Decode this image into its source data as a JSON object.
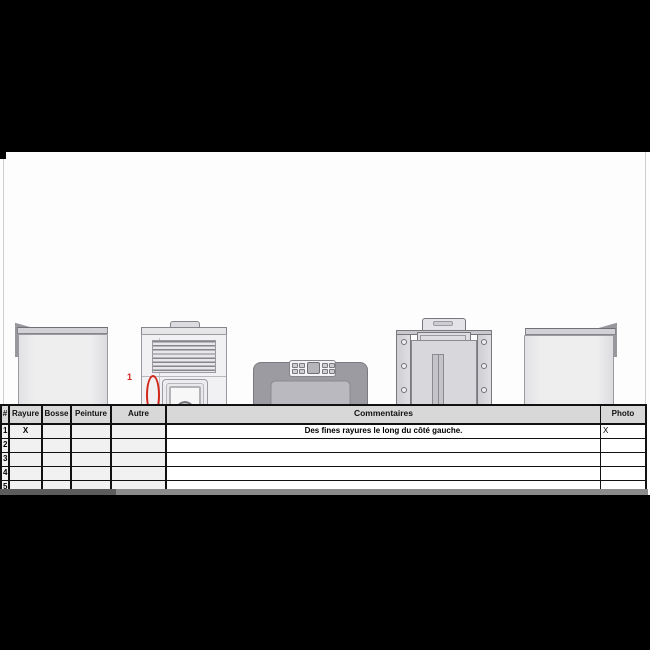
{
  "annotation": {
    "label": "1"
  },
  "colors": {
    "annotation_red": "#d2261a",
    "table_header_bg": "#d8d8d8",
    "letterbox": "#000000"
  },
  "table": {
    "headers": {
      "num": "#",
      "rayure": "Rayure",
      "bosse": "Bosse",
      "peinture": "Peinture",
      "autre": "Autre",
      "commentaires": "Commentaires",
      "photo": "Photo"
    },
    "rows": [
      {
        "num": "1",
        "rayure": "X",
        "bosse": "",
        "peinture": "",
        "autre": "",
        "commentaires": "Des fines rayures le long du côté gauche.",
        "photo": "X"
      },
      {
        "num": "2",
        "rayure": "",
        "bosse": "",
        "peinture": "",
        "autre": "",
        "commentaires": "",
        "photo": ""
      },
      {
        "num": "3",
        "rayure": "",
        "bosse": "",
        "peinture": "",
        "autre": "",
        "commentaires": "",
        "photo": ""
      },
      {
        "num": "4",
        "rayure": "",
        "bosse": "",
        "peinture": "",
        "autre": "",
        "commentaires": "",
        "photo": ""
      },
      {
        "num": "5",
        "rayure": "",
        "bosse": "",
        "peinture": "",
        "autre": "",
        "commentaires": "",
        "photo": ""
      }
    ]
  }
}
